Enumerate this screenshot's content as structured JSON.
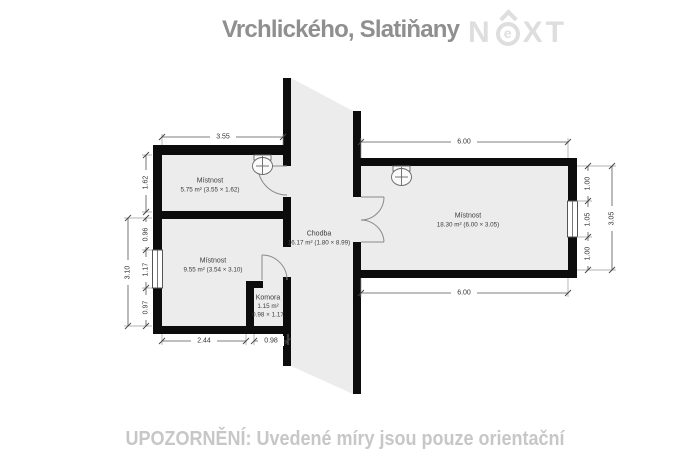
{
  "header": {
    "title": "Vrchlického, Slatiňany",
    "logo": {
      "n": "N",
      "e": "e",
      "xt": "XT"
    }
  },
  "footer": {
    "warning": "UPOZORNĚNÍ: Uvedené míry jsou pouze orientační"
  },
  "plan": {
    "rooms": {
      "room_top_left": {
        "name": "Místnost",
        "detail": "5.75 m² (3.55 × 1.62)"
      },
      "room_bottom_left": {
        "name": "Místnost",
        "detail": "9.55 m² (3.54 × 3.10)"
      },
      "komora": {
        "name": "Komora",
        "area": "1.15 m²",
        "size": "0.98 × 1.17"
      },
      "chodba": {
        "name": "Chodba",
        "detail": "16.17 m² (1.80 × 8.99)"
      },
      "room_right": {
        "name": "Místnost",
        "detail": "18.30 m² (6.00 × 3.05)"
      }
    },
    "dims": {
      "tl_width": "3.55",
      "tl_height": "1.62",
      "bl_seg1": "0.96",
      "bl_seg2": "1.17",
      "bl_seg3": "0.97",
      "bl_total": "3.10",
      "bottom_room": "2.44",
      "bottom_komora": "0.98",
      "r_top": "6.00",
      "r_bottom": "6.00",
      "r_seg1": "1.00",
      "r_seg2": "1.05",
      "r_seg3": "1.00",
      "r_total": "3.05"
    },
    "colors": {
      "room_fill": "#ececec",
      "wall": "#0c0c0c",
      "title_gray": "#8f8f8f",
      "logo_gray": "#dedede",
      "warning_gray": "#c7c7c7"
    }
  }
}
